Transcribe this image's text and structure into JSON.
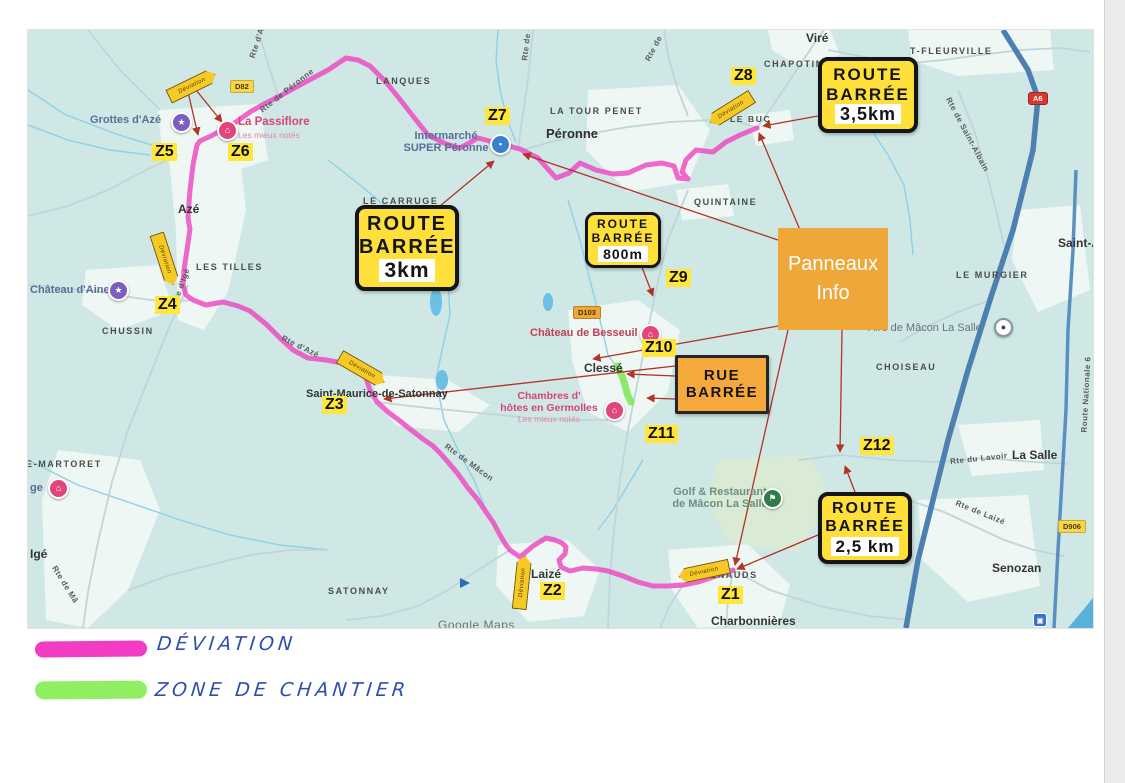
{
  "colors": {
    "deviation_pink": "#f23cc4",
    "chantier_green": "#8fee62",
    "sign_yellow": "#ffdf3a",
    "sign_orange": "#f5a93c",
    "panneaux_orange": "#f0a73a",
    "arrow_red": "#b23327",
    "map_teal": "#cfe8e6",
    "motorway_blue": "#4d7fb0"
  },
  "signs": {
    "barree_3km": {
      "l1": "ROUTE",
      "l2": "BARRÉE",
      "value": "3km"
    },
    "barree_800m": {
      "l1": "ROUTE",
      "l2": "BARRÉE",
      "value": "800m"
    },
    "barree_35km": {
      "l1": "ROUTE",
      "l2": "BARRÉE",
      "value": "3,5km"
    },
    "barree_25km": {
      "l1": "ROUTE",
      "l2": "BARRÉE",
      "value": "2,5 km"
    },
    "rue_barree": {
      "l1": "RUE",
      "l2": "BARRÉE"
    },
    "panneaux": {
      "l1": "Panneaux",
      "l2": "Info"
    },
    "deviation_arrow": "Déviation"
  },
  "zones": {
    "z1": "Z1",
    "z2": "Z2",
    "z3": "Z3",
    "z4": "Z4",
    "z5": "Z5",
    "z6": "Z6",
    "z7": "Z7",
    "z8": "Z8",
    "z9": "Z9",
    "z10": "Z10",
    "z11": "Z11",
    "z12": "Z12"
  },
  "towns": {
    "vire": "Viré",
    "chapotin": "CHAPOTIN",
    "fleurville": "T-FLEURVILLE",
    "lanques": "LANQUES",
    "la_tour_penet": "LA TOUR PENET",
    "peronne": "Péronne",
    "quintaine": "QUINTAINE",
    "le_buc": "LE BUC",
    "le_carruge": "LE CARRUGE",
    "aze": "Azé",
    "les_tilles": "LES TILLES",
    "chussin": "CHUSSIN",
    "saint_maurice": "Saint-Maurice-de-Satonnay",
    "clesse": "Clessé",
    "satonnay": "SATONNAY",
    "laize": "Laizé",
    "renauds": "RENAUDS",
    "charbonnieres": "Charbonnières",
    "senozan": "Senozan",
    "la_salle": "La Salle",
    "choiseau": "CHOISEAU",
    "le_murgier": "LE MURGIER",
    "saint_a": "Saint-A",
    "e_martoret": "E-MARTORET",
    "ige": "Igé"
  },
  "pois": {
    "grottes": "Grottes d'Azé",
    "passiflore": "La Passiflore",
    "mieux_notes": "Les mieux notés",
    "chateau_aine": "Château d'Aine",
    "intermarche_l1": "Intermarché",
    "intermarche_l2": "SUPER Péronne",
    "besseuil": "Château de Besseuil",
    "germolles_l1": "Chambres d'",
    "germolles_l2": "hôtes en Germolles",
    "golf_l1": "Golf & Restaurant",
    "golf_l2": "de Mâcon La Salle",
    "aire": "Aire de Mâcon La Salle",
    "ge": "ge"
  },
  "roads": {
    "rte_aze_top": "Rte d'Azé",
    "d82": "D82",
    "rte_peronne": "Rte de Péronne",
    "rte_chassigny": "Rte de Chassigny",
    "rte_de": "Rte de",
    "rte_saint_albain": "Rte de Saint-Albain",
    "a6": "A6",
    "rte_ige": "Rte d'Igé",
    "rte_aze_mid": "Rte d'Azé",
    "d103": "D103",
    "rte_macon": "Rte de Mâcon",
    "rte_ma": "Rte de Mâ",
    "rte_lavoir": "Rte du Lavoir",
    "rte_laize": "Rte de Laizé",
    "d906": "D906",
    "route_nationale": "Route Nationale 6"
  },
  "icons": {
    "star": "★",
    "house": "⌂",
    "flag": "⚑",
    "bag": "▪",
    "dot": "●",
    "station": "▣"
  },
  "legend": {
    "deviation": "DÉVIATION",
    "chantier": "ZONE DE CHANTIER"
  },
  "watermark": "Google Maps"
}
